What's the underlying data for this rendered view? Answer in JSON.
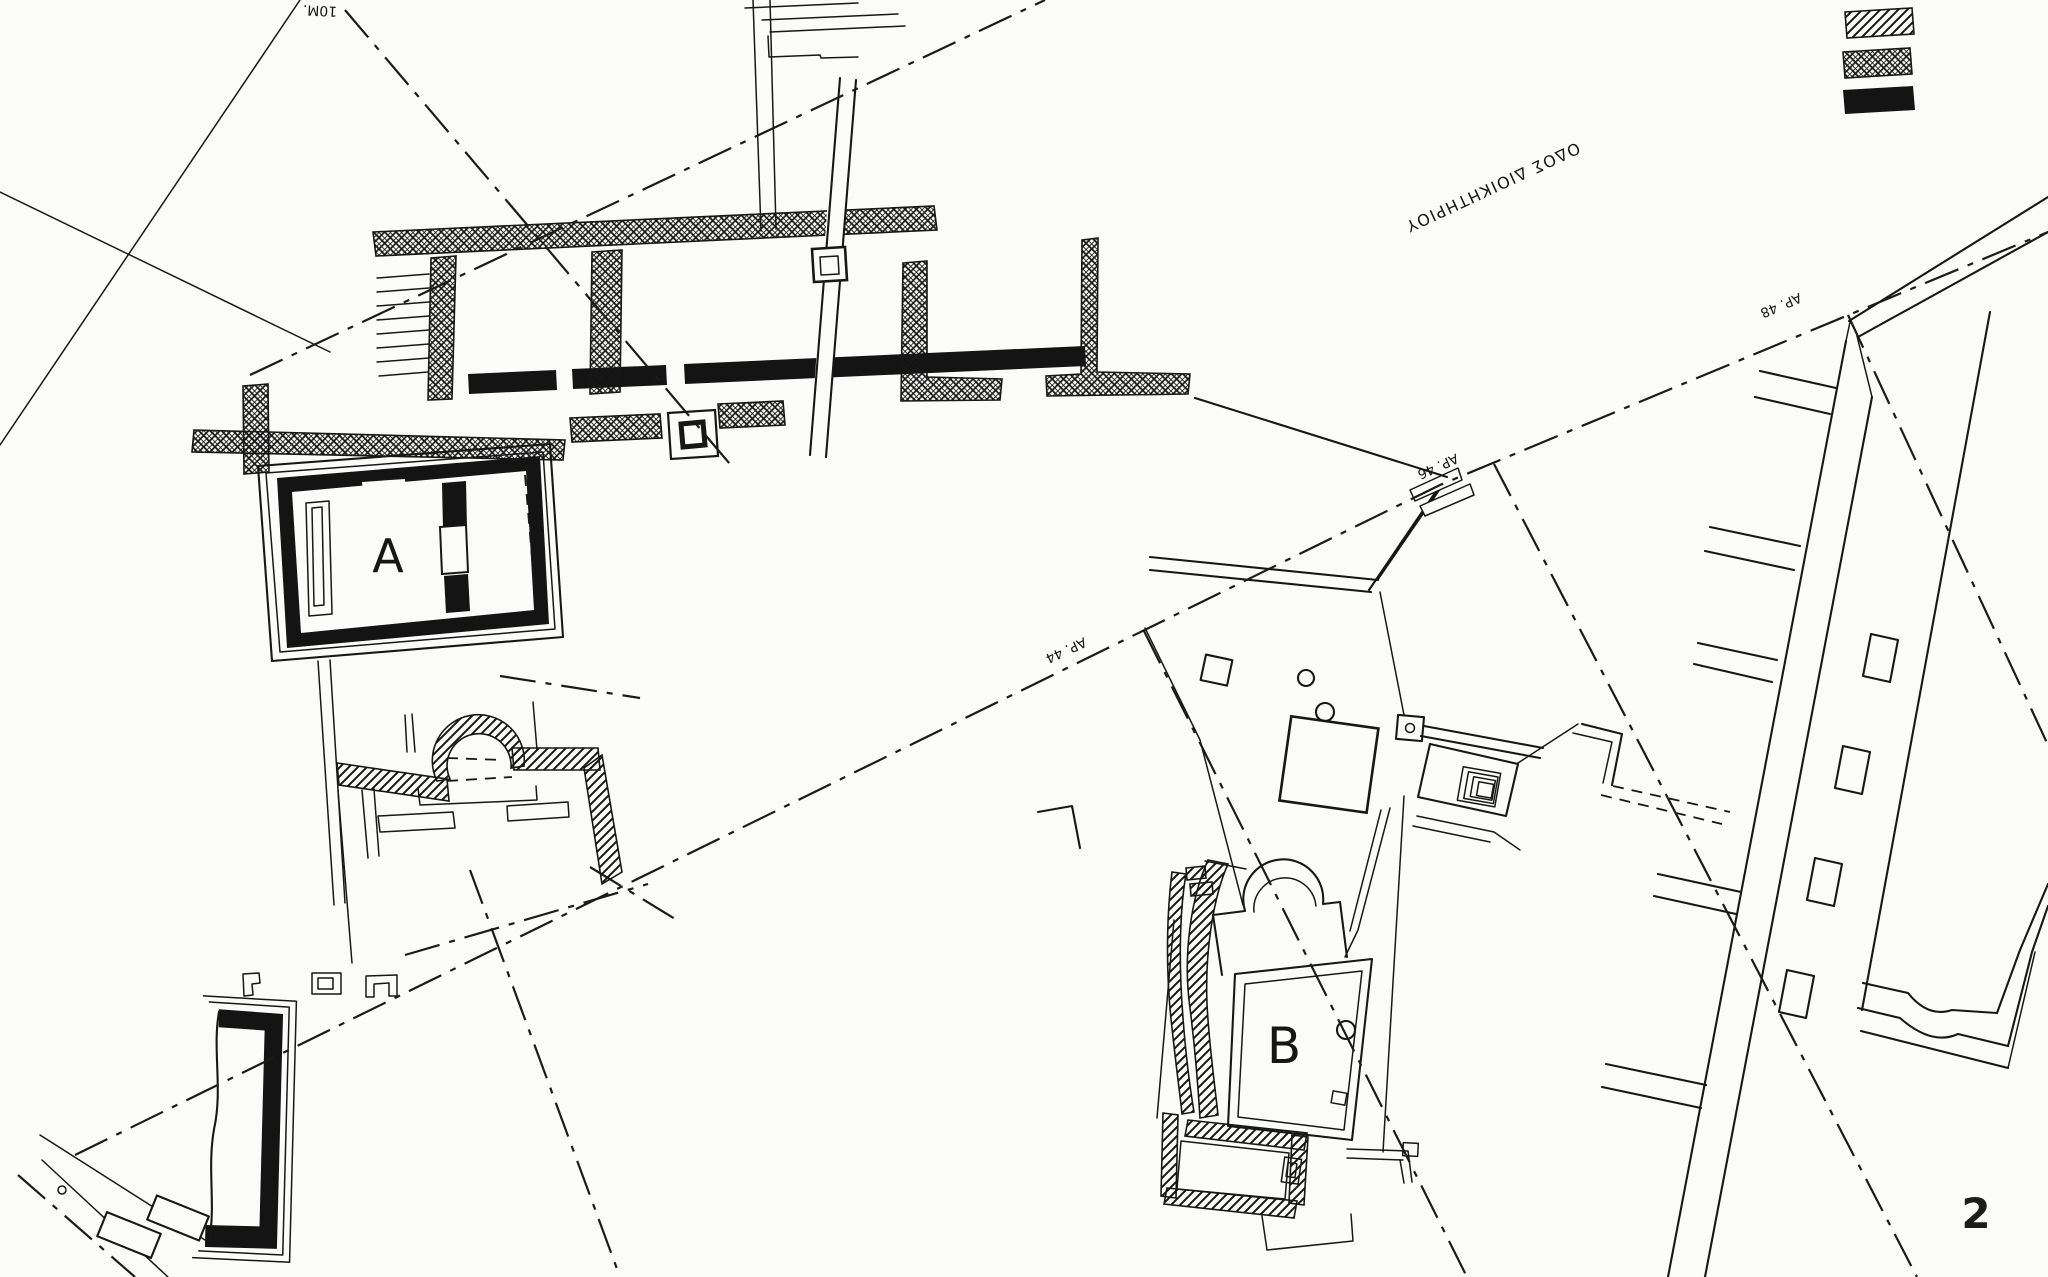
{
  "figure": {
    "page_number": "2",
    "building_labels": {
      "a": "A",
      "b": "B"
    },
    "scale_label": "10M.",
    "street_label": "ΟΔΟΣ ΔΙΟΙΚΗΤΗΡΙΟΥ",
    "address_labels": {
      "n44": "ΑΡ. 44",
      "n46": "ΑΡ. 46",
      "n48": "ΑΡ. 48"
    },
    "legend": {
      "items": [
        {
          "icon": "diagonal-hatch-swatch"
        },
        {
          "icon": "cross-hatch-swatch"
        },
        {
          "icon": "solid-black-swatch"
        }
      ]
    },
    "colors": {
      "ink": "#171717",
      "paper": "#fbfbf9",
      "figure_number_ink": "#1c1c1c"
    }
  }
}
